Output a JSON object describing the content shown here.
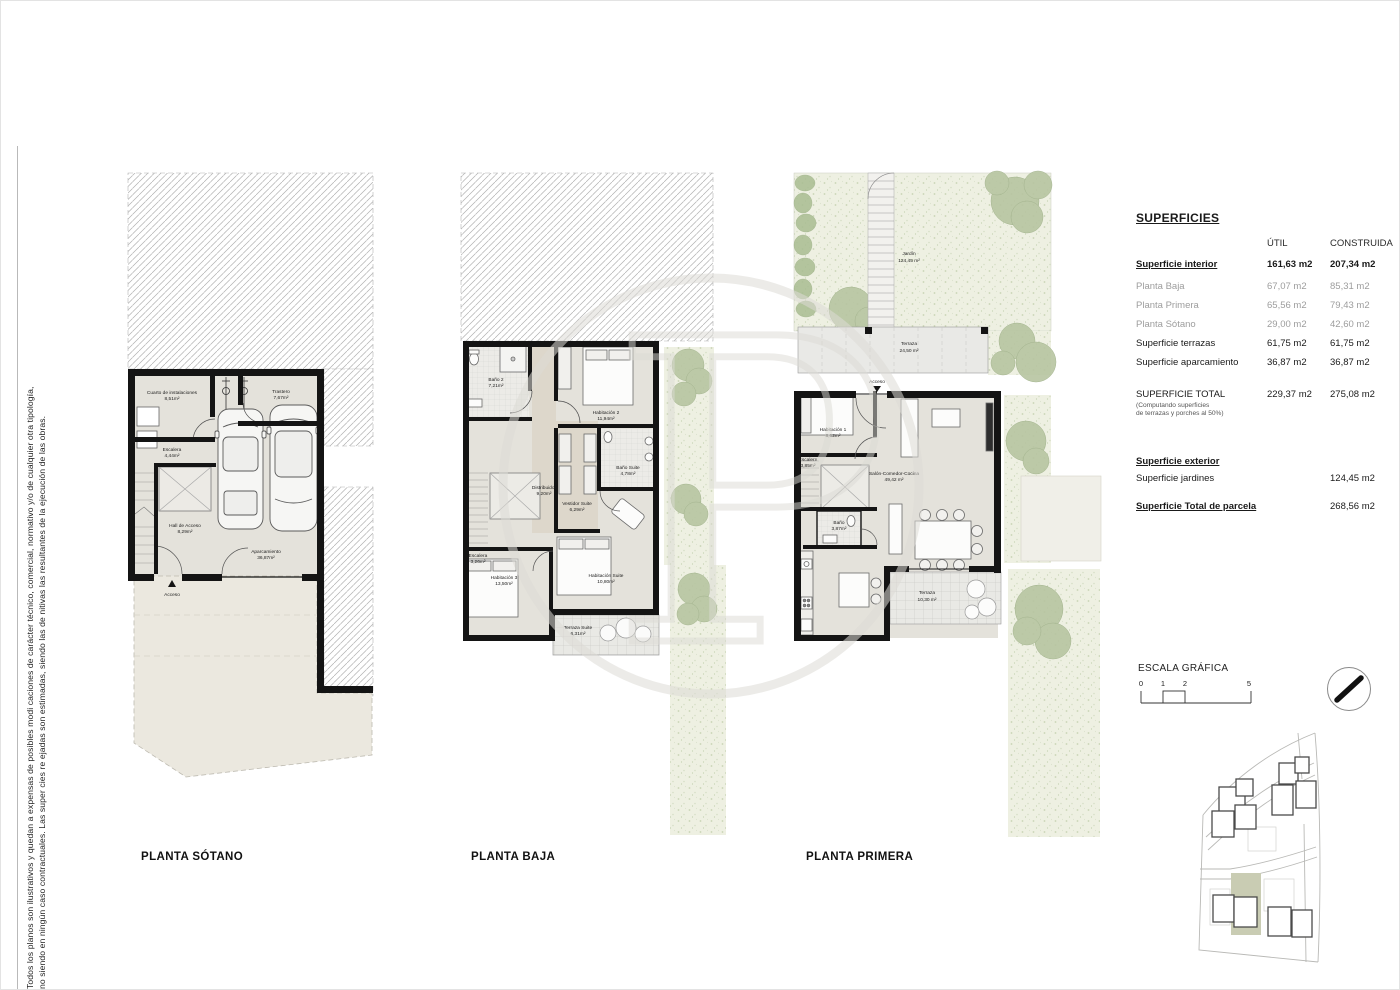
{
  "sheet": {
    "disclaimer_line1": "Todos los planos son ilustrativos y quedan a expensas de posibles modi caciones de carácter técnico, comercial, normativo y/o de cualquier otra tipología,",
    "disclaimer_line2": "no siendo en ningún caso contractuales. Las super cies re ejadas son estimadas, siendo las de nitivas las resultantes de la ejecución de las obras."
  },
  "plans": {
    "sotano": {
      "title": "PLANTA SÓTANO",
      "access_label": "Acceso",
      "rooms": [
        {
          "name": "Cuarto de instalaciones",
          "area": "8,51m²"
        },
        {
          "name": "Trastero",
          "area": "7,67m²"
        },
        {
          "name": "Escalera",
          "area": "4,44m²"
        },
        {
          "name": "Hall de Acceso",
          "area": "8,29m²"
        },
        {
          "name": "Aparcamiento",
          "area": "36,87m²"
        }
      ]
    },
    "baja": {
      "title": "PLANTA BAJA",
      "rooms": [
        {
          "name": "Baño 2",
          "area": "7,21m²"
        },
        {
          "name": "Habitación 2",
          "area": "11,94m²"
        },
        {
          "name": "Distribuidor",
          "area": "9,20m²"
        },
        {
          "name": "Baño Suite",
          "area": "4,78m²"
        },
        {
          "name": "Vestidor Suite",
          "area": "6,29m²"
        },
        {
          "name": "Escalera",
          "area": "3,26m²"
        },
        {
          "name": "Habitación 3",
          "area": "13,50m²"
        },
        {
          "name": "Habitación Suite",
          "area": "10,80m²"
        },
        {
          "name": "Terraza Suite",
          "area": "6,31m²"
        }
      ]
    },
    "primera": {
      "title": "PLANTA PRIMERA",
      "access_label": "Acceso",
      "rooms": [
        {
          "name": "Jardín",
          "area": "124,45 m²"
        },
        {
          "name": "Terraza",
          "area": "24,50 m²"
        },
        {
          "name": "Habitación 1",
          "area": "8,62m²"
        },
        {
          "name": "Escalera",
          "area": "3,85m²"
        },
        {
          "name": "Salón-Comedor-Cocina",
          "area": "49,42 m²"
        },
        {
          "name": "Baño",
          "area": "3,87m²"
        },
        {
          "name": "Terraza",
          "area": "10,30 m²"
        }
      ]
    }
  },
  "table": {
    "title": "SUPERFICIES",
    "col_util": "ÚTIL",
    "col_construida": "CONSTRUIDA",
    "rows": [
      {
        "label": "Superficie interior",
        "util": "161,63 m2",
        "construida": "207,34 m2"
      },
      {
        "label": "Planta Baja",
        "util": "67,07 m2",
        "construida": "85,31 m2"
      },
      {
        "label": "Planta Primera",
        "util": "65,56 m2",
        "construida": "79,43 m2"
      },
      {
        "label": "Planta Sótano",
        "util": "29,00 m2",
        "construida": "42,60 m2"
      },
      {
        "label": "Superficie terrazas",
        "util": "61,75 m2",
        "construida": "61,75 m2"
      },
      {
        "label": "Superficie aparcamiento",
        "util": "36,87 m2",
        "construida": "36,87 m2"
      }
    ],
    "total": {
      "label": "SUPERFICIE TOTAL",
      "note1": "(Computando superficies",
      "note2": " de terrazas y porches al 50%)",
      "util": "229,37 m2",
      "construida": "275,08 m2"
    },
    "exterior_header": "Superficie exterior",
    "jardines": {
      "label": "Superficie jardines",
      "construida": "124,45 m2"
    },
    "parcela": {
      "label": "Superficie Total de parcela",
      "construida": "268,56 m2"
    }
  },
  "scale": {
    "label": "ESCALA GRÁFICA",
    "ticks": [
      "0",
      "1",
      "2",
      "5"
    ]
  },
  "colors": {
    "wall": "#141414",
    "floor": "#e4e2db",
    "garden_bg": "#eef0e2",
    "tree": "#b7c5a1",
    "highlight_plot": "#c9ccb3"
  }
}
